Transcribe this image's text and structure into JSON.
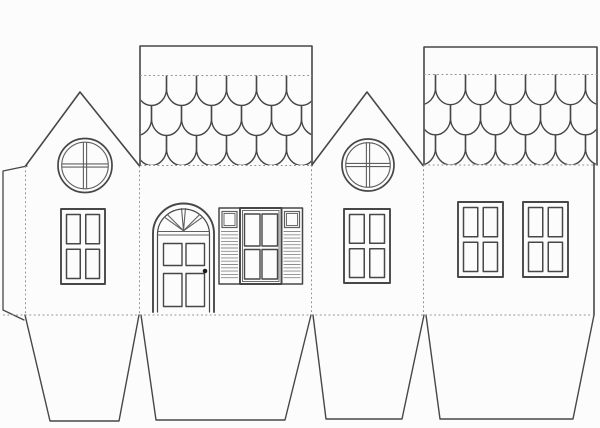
{
  "colors": {
    "background": "#fcfcfc",
    "line": "#474747",
    "line_soft": "#5f5f5f",
    "louver": "#8c8c8c",
    "dash": "#909090",
    "knob": "#1c1c1c"
  },
  "sheet": {
    "width": 600,
    "height": 428
  },
  "four_pane_style": {
    "margin": 5.5,
    "gap": 5.5,
    "outer_stroke": 1.9,
    "pane_stroke": 1.5
  },
  "shingle": {
    "width": 30,
    "rows": 3,
    "rx": 15,
    "ry": 17
  },
  "parts": {
    "glue_tab": {
      "name": "glue-tab-left",
      "outline": [
        [
          27,
          166
        ],
        [
          3,
          171
        ],
        [
          3,
          310
        ],
        [
          24,
          320
        ]
      ]
    },
    "gables": [
      {
        "name": "gable-wall-left",
        "outline": [
          [
            25.5,
            166
          ],
          [
            80,
            92
          ],
          [
            139.5,
            166
          ]
        ],
        "round_window": {
          "name": "round-window-left",
          "cx": 85,
          "cy": 165.5,
          "r": 27,
          "r_inner": 23.3
        },
        "window": {
          "name": "gable-left-window",
          "x": 61,
          "y": 209,
          "w": 44,
          "h": 75
        }
      },
      {
        "name": "gable-wall-right",
        "outline": [
          [
            311.5,
            165.5
          ],
          [
            367,
            92
          ],
          [
            423,
            165.5
          ]
        ],
        "round_window": {
          "name": "round-window-right",
          "cx": 368,
          "cy": 165,
          "r": 26,
          "r_inner": 22.3
        },
        "window": {
          "name": "gable-right-window",
          "x": 344,
          "y": 209,
          "w": 46,
          "h": 74
        }
      }
    ],
    "roofs": [
      {
        "name": "roof-panel-left",
        "x": 140,
        "top": 46,
        "right": 312,
        "eave": 165.5,
        "ridge_fold": 75.5,
        "phases": [
          -3.5,
          11.5
        ]
      },
      {
        "name": "roof-panel-right",
        "x": 424,
        "top": 47,
        "right": 597,
        "eave": 165,
        "ridge_fold": 74.5,
        "phases": [
          11.5,
          -3.5
        ]
      }
    ],
    "side_wall": {
      "name": "side-wall",
      "right_edge_x": 594,
      "top_y": 164,
      "bottom_y": 315
    },
    "door": {
      "name": "front-door",
      "cx": 183.5,
      "left": 153,
      "right": 214,
      "bottom": 312,
      "spring_y": 233.5,
      "r_outer": 30.5,
      "r_inner": 26,
      "transom_y1": 231.5,
      "transom_y2": 235,
      "fan": {
        "name": "fanlight",
        "angles": [
          45,
          90,
          135
        ],
        "spread_deg": 4.5,
        "apex_y": 230.8
      },
      "panels": {
        "left_x": 163.5,
        "right_x": 186,
        "w": 18.5,
        "top_y": 243.5,
        "top_h": 22,
        "bot_y": 273.5,
        "bot_h": 33
      },
      "knob": {
        "name": "doorknob",
        "cx": 205,
        "cy": 271,
        "r": 2.3
      }
    },
    "shuttered_window": {
      "name": "shuttered-window",
      "x": 219,
      "y": 208,
      "h": 76,
      "shutter_w": 21,
      "window_x": 240,
      "window_w": 41.5,
      "right_shutter_x": 281.5,
      "square": {
        "inset": 3,
        "h": 16
      },
      "louver_top": 231.5,
      "louver_step": 3.3
    },
    "side_windows": [
      {
        "name": "side-window-left",
        "x": 458,
        "y": 202,
        "w": 45,
        "h": 75
      },
      {
        "name": "side-window-right",
        "x": 523,
        "y": 202,
        "w": 45,
        "h": 75
      }
    ],
    "flaps": [
      {
        "name": "bottom-flap-1",
        "pts": [
          [
            25,
            315
          ],
          [
            50,
            421
          ],
          [
            119,
            421
          ],
          [
            139,
            315
          ]
        ]
      },
      {
        "name": "bottom-flap-2",
        "pts": [
          [
            141,
            315
          ],
          [
            156,
            420
          ],
          [
            285,
            420
          ],
          [
            311,
            315
          ]
        ]
      },
      {
        "name": "bottom-flap-3",
        "pts": [
          [
            313,
            315
          ],
          [
            326,
            419
          ],
          [
            402,
            419
          ],
          [
            424,
            315
          ]
        ]
      },
      {
        "name": "bottom-flap-4",
        "pts": [
          [
            426,
            315
          ],
          [
            440,
            419
          ],
          [
            573,
            419
          ],
          [
            594,
            315
          ]
        ]
      }
    ],
    "fold_lines": [
      {
        "name": "fold-glue-tab",
        "x1": 25.5,
        "y1": 166,
        "x2": 25.5,
        "y2": 315
      },
      {
        "name": "fold-gable-left-front",
        "x1": 139.5,
        "y1": 166,
        "x2": 139.5,
        "y2": 315
      },
      {
        "name": "fold-front-gable-right",
        "x1": 311.5,
        "y1": 165,
        "x2": 311.5,
        "y2": 315
      },
      {
        "name": "fold-gable-right-side",
        "x1": 423.5,
        "y1": 165,
        "x2": 423.5,
        "y2": 315
      },
      {
        "name": "fold-bottom",
        "x1": 3,
        "y1": 315,
        "x2": 594,
        "y2": 315
      },
      {
        "name": "fold-roof-left-eave",
        "x1": 140,
        "y1": 165.5,
        "x2": 312,
        "y2": 165.5
      },
      {
        "name": "fold-roof-left-ridge",
        "x1": 140,
        "y1": 75.5,
        "x2": 312,
        "y2": 75.5
      },
      {
        "name": "fold-roof-right-eave",
        "x1": 424,
        "y1": 165,
        "x2": 597,
        "y2": 165
      },
      {
        "name": "fold-roof-right-ridge",
        "x1": 424,
        "y1": 74.5,
        "x2": 597,
        "y2": 74.5
      }
    ]
  }
}
